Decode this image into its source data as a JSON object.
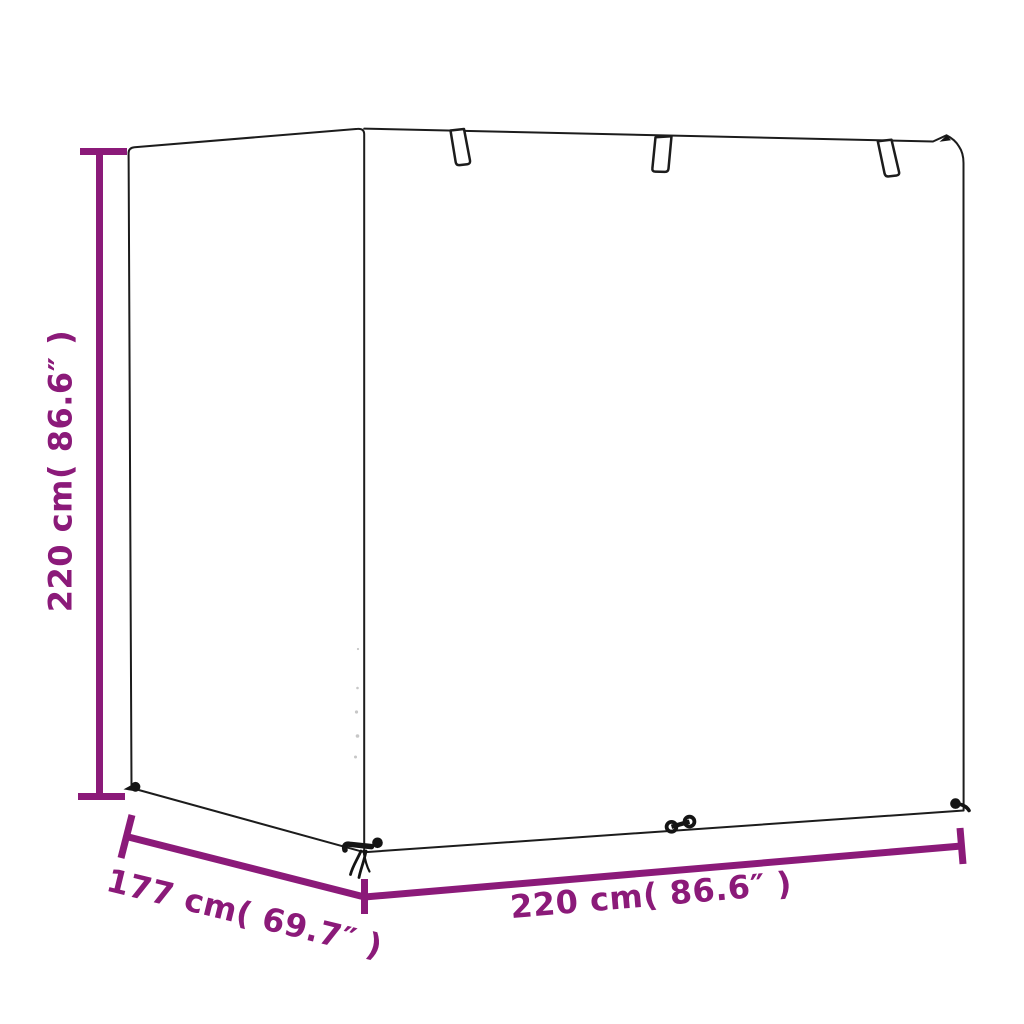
{
  "figure": {
    "name": "garden-swing-bench-cover-dimension-diagram",
    "background": "#ffffff",
    "outline_color": "#1c1c1c",
    "accent_color": "#8B1A79",
    "labels": {
      "height": "220 cm( 86.6″ )",
      "depth": "177 cm( 69.7″ )",
      "width": "220 cm( 86.6″ )"
    },
    "values": {
      "height_cm": 220,
      "height_in": 86.6,
      "depth_cm": 177,
      "depth_in": 69.7,
      "width_cm": 220,
      "width_in": 86.6
    },
    "features": {
      "top_straps": 3,
      "bottom_toggles": 4
    }
  }
}
